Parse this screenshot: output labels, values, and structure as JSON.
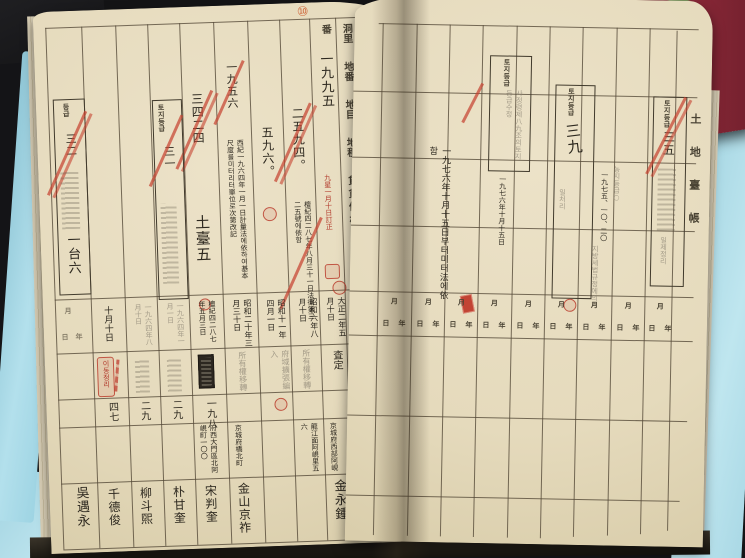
{
  "photo": {
    "page_number_mark": "⑩",
    "edge_title": "土地臺帳"
  },
  "left_page": {
    "headers": {
      "village": "洞里",
      "lot": "地番",
      "ban": "番",
      "category": "地目",
      "area": "地積",
      "price": "賃貸價格",
      "history": "沿革",
      "date": "年月日",
      "cause": "事故",
      "address": "住所",
      "owner": "所有者",
      "name": "氏名又ハ名稱",
      "grade": "等級"
    },
    "spine": {
      "value": "三五",
      "grades_red": "九六八一六"
    },
    "top": {
      "lot_number": "一九九五",
      "price_old": "二五九四。",
      "area_value": "五九六。",
      "num_struck_a": "三四二四",
      "num_struck_b": "一九五六",
      "metric_note": "西紀一九六四年一月一日計量法에依하여基本尺度를미터리터單位로次第改記",
      "legal_note": "檀紀四二八七年八月三十一日法律第三二五號에依함",
      "red_note": "九星一月十日訂正",
      "mark_large_a": "土臺五",
      "mark_large_b": "一台六",
      "box_left_label": "등급",
      "box_left_value": "三二",
      "box_mid_label": "토지등급",
      "box_mid_value": "三一"
    },
    "records": [
      {
        "date": "大正二年五月十日",
        "cause": "査定",
        "num": "",
        "address": "京城府西部阿峴",
        "name": "金永鍾"
      },
      {
        "date": "昭和六年八月十日",
        "cause": "所有權移轉",
        "num": "",
        "address": "龍江面阿峴里五六",
        "name": ""
      },
      {
        "date": "昭和十一年四月一日",
        "cause": "府域擴張編入",
        "num": "",
        "address": "",
        "name": ""
      },
      {
        "date": "昭和二十年三月三十日",
        "cause": "所有權移轉",
        "num": "",
        "address": "京城府橋北町",
        "name": "金山京祚"
      },
      {
        "date": "檀紀四二八七年五月三日",
        "cause": "",
        "num": "一九八",
        "address": "府西大門區北阿峴町一〇〇",
        "name": "宋判奎"
      },
      {
        "date": "一九六四年一月一日",
        "cause": "",
        "num": "二九",
        "address": "",
        "name": "朴甘奎"
      },
      {
        "date": "一九六四年八月十日",
        "cause": "",
        "num": "二九",
        "address": "",
        "name": "柳斗煕"
      },
      {
        "date": "十月十日",
        "cause": "이동정리",
        "num": "四七",
        "address": "",
        "name": "千德俊"
      },
      {
        "date": "",
        "cause": "",
        "num": "",
        "address": "",
        "name": "吳遇永"
      }
    ]
  },
  "right_page": {
    "margin_title": "土地臺帳",
    "spine_note": "一九七六年十月十五日부터미터法에依함",
    "box_a": {
      "label": "토지등급",
      "body": "사정령제八九조의토지등급수정",
      "date": "一九七六年十月十五日"
    },
    "box_b": {
      "label": "토지등급",
      "value": "三九"
    },
    "annex": {
      "sub_label": "농지등급○",
      "sub_date": "一九七五、一〇、二〇"
    },
    "box_c": {
      "label": "토지등급",
      "value": "三五"
    },
    "stamps": {
      "tax": "지방세법규정에의거",
      "batch": "일제정리",
      "process": "일처리"
    },
    "date_cell": {
      "month": "月",
      "day": "日",
      "year": "年"
    }
  }
}
